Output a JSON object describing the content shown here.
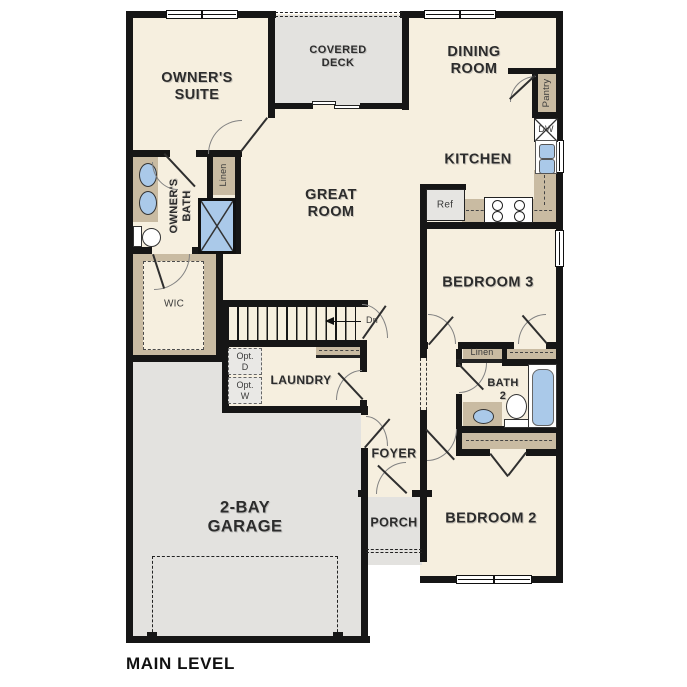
{
  "plan_title": "MAIN LEVEL",
  "rooms": {
    "owners_suite": {
      "line1": "OWNER'S",
      "line2": "SUITE"
    },
    "covered_deck": {
      "line1": "COVERED",
      "line2": "DECK"
    },
    "dining_room": {
      "line1": "DINING",
      "line2": "ROOM"
    },
    "great_room": {
      "line1": "GREAT",
      "line2": "ROOM"
    },
    "kitchen": {
      "label": "KITCHEN"
    },
    "owners_bath": {
      "line1": "OWNER'S",
      "line2": "BATH"
    },
    "wic": {
      "label": "WIC"
    },
    "laundry": {
      "label": "LAUNDRY"
    },
    "foyer": {
      "label": "FOYER"
    },
    "porch": {
      "label": "PORCH"
    },
    "garage": {
      "line1": "2-BAY",
      "line2": "GARAGE"
    },
    "bedroom_3": {
      "label": "BEDROOM 3"
    },
    "bath_2": {
      "line1": "BATH",
      "line2": "2"
    },
    "bedroom_2": {
      "label": "BEDROOM 2"
    }
  },
  "annotations": {
    "pantry": "Pantry",
    "dishwasher": "DW",
    "refrigerator": "Ref",
    "linen_owners": "Linen",
    "linen_hall": "Linen",
    "stair_direction": "Dn",
    "opt_dryer": {
      "line1": "Opt.",
      "line2": "D"
    },
    "opt_washer": {
      "line1": "Opt.",
      "line2": "W"
    }
  },
  "colors": {
    "wall": "#161616",
    "floor": "#f6efdf",
    "outdoor": "#e3e2df",
    "cabinet": "#c9bba2",
    "fixture": "#aac9e9",
    "text": "#2c2c2c"
  }
}
